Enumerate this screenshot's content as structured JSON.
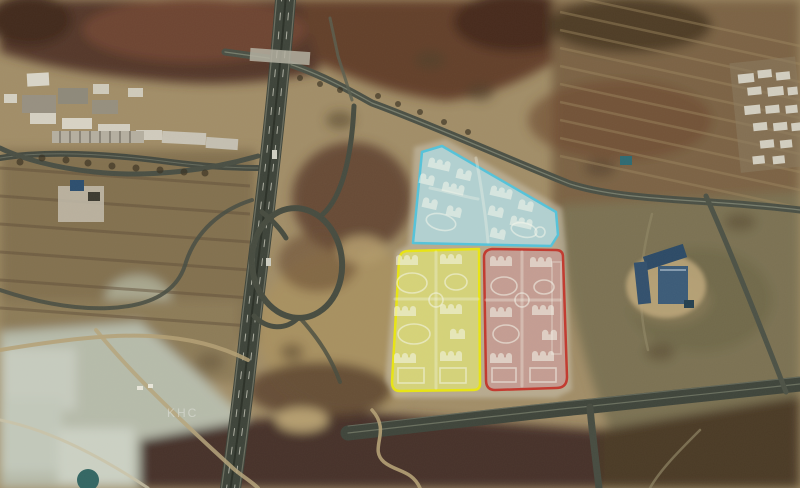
{
  "map": {
    "kind": "satellite-aerial-view-with-site-plan-overlays",
    "watermark": "KHC",
    "parcels": {
      "blue": {
        "name": "north parcel (blue phase)",
        "fill": "#b2dbe2",
        "stroke": "#55c3da"
      },
      "yellow": {
        "name": "southwest parcel (yellow phase)",
        "fill": "#dddd74",
        "stroke": "#e9e512"
      },
      "red": {
        "name": "southeast parcel (red phase)",
        "fill": "#c79a94",
        "stroke": "#c2392e"
      }
    },
    "colors": {
      "terrain_base": "#a28e68",
      "hills_dark_brown": "#54392b",
      "fields_olive": "#7b7253",
      "road_asphalt": "#3e443a",
      "pond_pale": "#c3c9bb"
    }
  }
}
